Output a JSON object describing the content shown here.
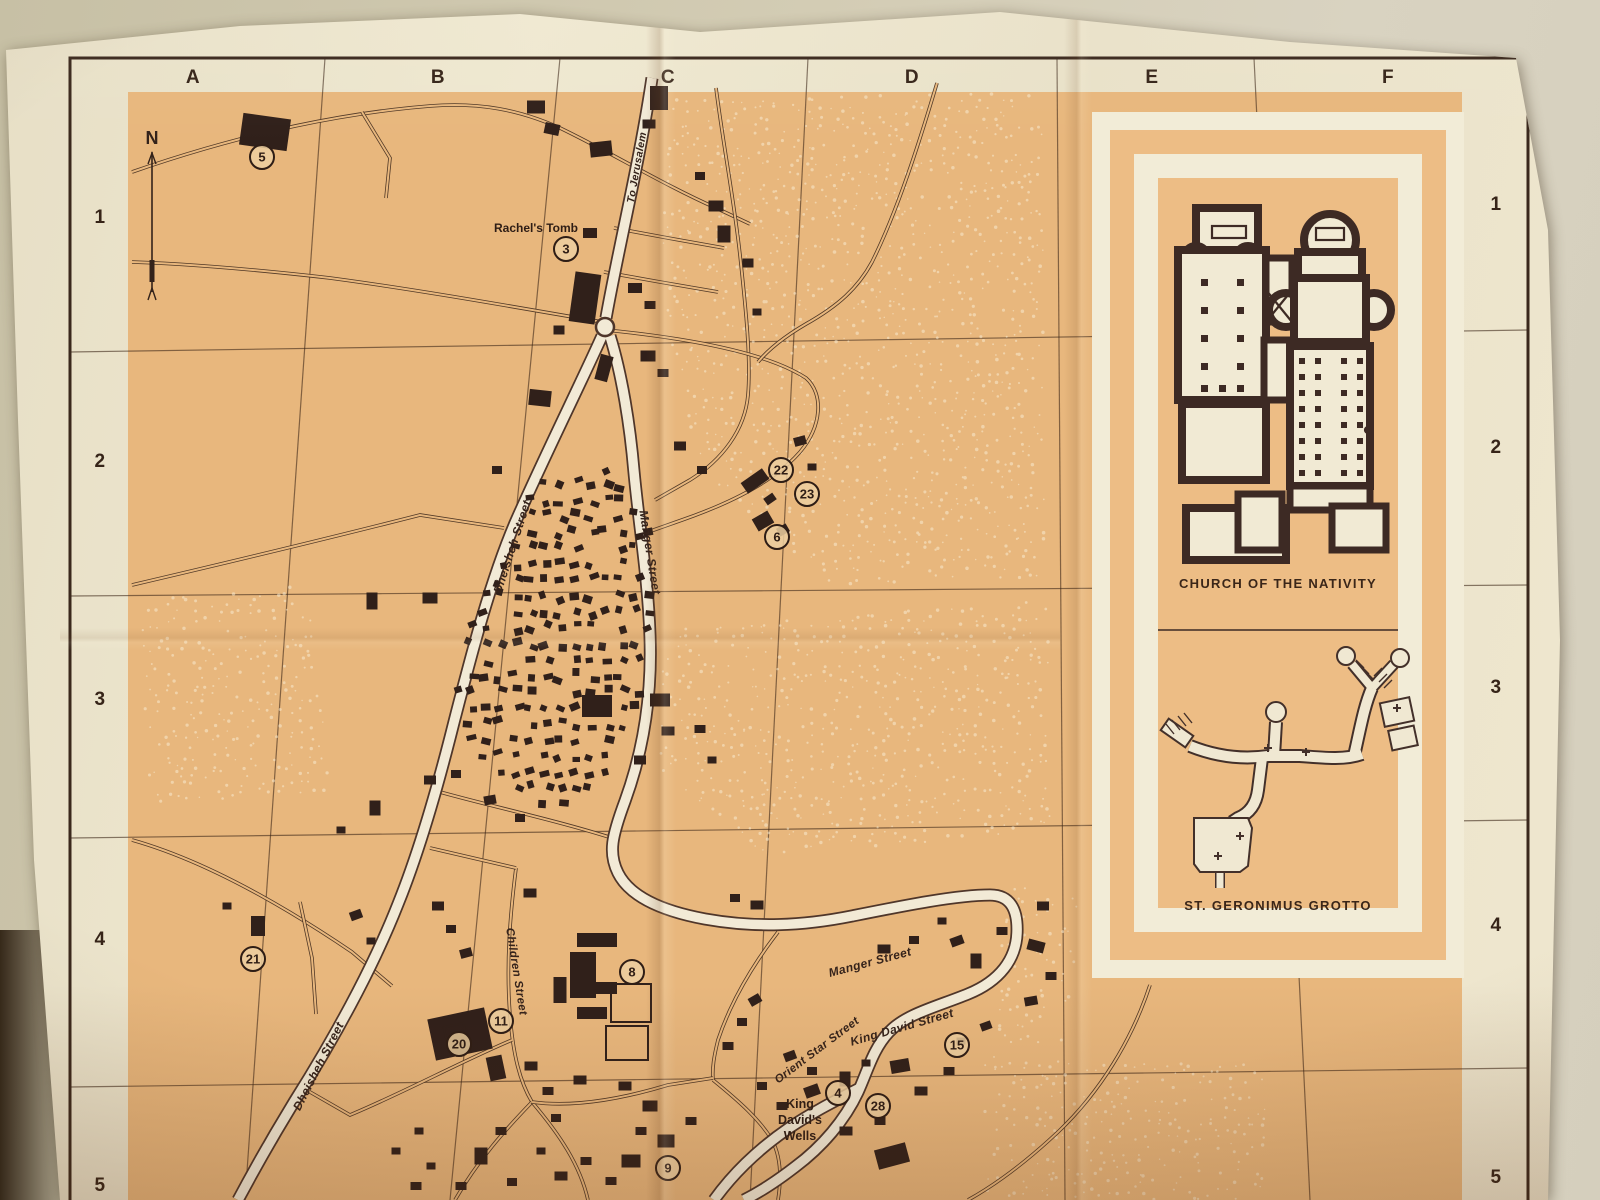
{
  "map_title_note": "Bethlehem street map sheet",
  "grid": {
    "columns": [
      "A",
      "B",
      "C",
      "D",
      "E",
      "F"
    ],
    "rows": [
      "1",
      "2",
      "3",
      "4",
      "5"
    ],
    "col_x": [
      193,
      438,
      668,
      912,
      1152,
      1388
    ],
    "row_left_y": [
      218,
      462,
      700,
      940,
      1186
    ],
    "row_right_y": [
      205,
      448,
      688,
      926,
      1178
    ]
  },
  "compass": {
    "label": "N",
    "x": 152,
    "y": 152
  },
  "inset": {
    "church_title": "CHURCH OF THE NATIVITY",
    "grotto_title": "ST. GERONIMUS GROTTO"
  },
  "colors": {
    "map_orange": "#e8b77d",
    "paper_cream": "#ece4cb",
    "line_dark": "#3a281c",
    "building": "#30201a",
    "road_fill": "#f2ead6",
    "road_casing": "#4f362a",
    "poi_fill": "#eccfa0",
    "inset_white": "#f2ecd7",
    "inset_orange": "#edbd85",
    "plan_wall": "#3d2a24",
    "speckle": "#f8ebd0"
  },
  "pois": [
    {
      "num": "5",
      "x": 262,
      "y": 157
    },
    {
      "num": "3",
      "x": 566,
      "y": 249
    },
    {
      "num": "22",
      "x": 781,
      "y": 470
    },
    {
      "num": "23",
      "x": 807,
      "y": 494
    },
    {
      "num": "6",
      "x": 777,
      "y": 537
    },
    {
      "num": "21",
      "x": 253,
      "y": 959
    },
    {
      "num": "8",
      "x": 632,
      "y": 972
    },
    {
      "num": "11",
      "x": 501,
      "y": 1021
    },
    {
      "num": "20",
      "x": 459,
      "y": 1044
    },
    {
      "num": "15",
      "x": 957,
      "y": 1045
    },
    {
      "num": "4",
      "x": 838,
      "y": 1093
    },
    {
      "num": "28",
      "x": 878,
      "y": 1106
    },
    {
      "num": "9",
      "x": 668,
      "y": 1168
    }
  ],
  "poi_labels": [
    {
      "text": "Rachel's Tomb",
      "x": 536,
      "y": 232,
      "rot": 0,
      "size": 12
    },
    {
      "text": "King",
      "x": 800,
      "y": 1108,
      "rot": 0,
      "size": 12.5
    },
    {
      "text": "David's",
      "x": 800,
      "y": 1124,
      "rot": 0,
      "size": 12.5
    },
    {
      "text": "Wells",
      "x": 800,
      "y": 1140,
      "rot": 0,
      "size": 12.5
    }
  ],
  "street_labels": [
    {
      "text": "To Jerusalem",
      "x": 640,
      "y": 168,
      "rot": -80,
      "size": 10.5
    },
    {
      "text": "Dheisheh Street",
      "x": 516,
      "y": 548,
      "rot": -72,
      "size": 12
    },
    {
      "text": "Manger Street",
      "x": 646,
      "y": 553,
      "rot": 81,
      "size": 12
    },
    {
      "text": "Children Street",
      "x": 513,
      "y": 972,
      "rot": 81,
      "size": 11.5
    },
    {
      "text": "Dheisheh Street",
      "x": 322,
      "y": 1068,
      "rot": -63,
      "size": 12
    },
    {
      "text": "Manger Street",
      "x": 871,
      "y": 966,
      "rot": -15,
      "size": 12
    },
    {
      "text": "Orient Star Street",
      "x": 819,
      "y": 1053,
      "rot": -37,
      "size": 11.5
    },
    {
      "text": "King David Street",
      "x": 903,
      "y": 1031,
      "rot": -16,
      "size": 12
    }
  ],
  "geometry": {
    "roundabout": {
      "x": 605,
      "y": 327,
      "r": 9
    },
    "roads_wide": [
      {
        "id": "jerusalem-road",
        "d": "M652,78 C640,160 618,250 606,318"
      },
      {
        "id": "dheisheh-street",
        "d": "M602,336 C580,385 545,455 515,523 C490,582 472,652 454,722 C437,790 417,857 398,904 C372,970 332,1042 294,1102 C272,1138 254,1170 238,1200"
      },
      {
        "id": "manger-street",
        "d": "M610,336 C622,375 630,425 634,472 C639,525 648,578 650,636 C652,691 645,746 625,801 C612,836 608,853 618,873 C630,897 662,911 705,919 C755,928 802,926 852,916 C902,906 956,895 990,895 C1010,895 1018,909 1017,933 C1016,959 1000,981 968,994 C936,1007 906,1014 889,1032 C873,1049 868,1070 858,1092 C845,1120 822,1147 795,1167 C773,1184 756,1194 744,1200"
      },
      {
        "id": "south-approach",
        "d": "M714,1200 C732,1175 757,1150 789,1128 C816,1110 841,1098 860,1088"
      }
    ],
    "roads_thin": [
      {
        "id": "north-lane",
        "d": "M132,172 C230,138 330,114 430,106 C480,102 520,110 560,128 C610,152 662,184 716,208 L750,224"
      },
      {
        "id": "north-lane-spur",
        "d": "M362,112 L390,158 L386,198"
      },
      {
        "id": "east-parallel-lane",
        "d": "M716,88 C724,150 734,200 740,255 C746,310 751,360 748,395 C745,430 722,460 690,480 L655,500"
      },
      {
        "id": "fork-east-loop",
        "d": "M606,330 C686,338 766,352 806,378 C824,394 822,426 800,452 C774,482 728,504 682,520 L648,532"
      },
      {
        "id": "d-column-road",
        "d": "M937,83 C920,140 898,210 872,262 C858,288 838,306 806,324 C782,338 768,350 758,362"
      },
      {
        "id": "cross-lane-1",
        "d": "M614,228 L668,238 L724,248"
      },
      {
        "id": "cross-lane-2",
        "d": "M604,272 L660,282 L718,292"
      },
      {
        "id": "west-lane",
        "d": "M602,322 C520,308 420,290 330,278 C260,270 190,264 132,262"
      },
      {
        "id": "west-lane-2",
        "d": "M132,585 C230,562 330,538 420,515 L504,528"
      },
      {
        "id": "southwest-lane",
        "d": "M132,840 C210,862 290,910 352,952 L392,986"
      },
      {
        "id": "southwest-spur",
        "d": "M300,902 L312,958 L316,1014"
      },
      {
        "id": "children-street",
        "d": "M516,868 C510,915 506,965 510,1015 C513,1055 520,1082 532,1102"
      },
      {
        "id": "children-link",
        "d": "M430,848 L516,868"
      },
      {
        "id": "camp-south-lane",
        "d": "M440,792 C490,806 555,820 612,838"
      },
      {
        "id": "orient-star-street",
        "d": "M778,932 C755,962 732,998 718,1040 C714,1056 712,1068 713,1080"
      },
      {
        "id": "inset-foot-road",
        "d": "M1150,985 C1132,1040 1100,1092 1058,1132 C1025,1163 995,1185 968,1200"
      },
      {
        "id": "town-sw-1",
        "d": "M532,1102 C505,1130 478,1160 455,1200"
      },
      {
        "id": "town-sw-2",
        "d": "M532,1102 C560,1135 580,1165 588,1200"
      },
      {
        "id": "town-east-link",
        "d": "M532,1102 C575,1108 625,1098 668,1085 L713,1078"
      },
      {
        "id": "town-west-link",
        "d": "M512,1040 C460,1062 405,1092 350,1115 L303,1088"
      },
      {
        "id": "wells-south-lane",
        "d": "M713,1080 C740,1102 760,1120 772,1140 C780,1155 782,1175 778,1200"
      }
    ],
    "grid_v": [
      [
        325,
        58,
        245,
        1200
      ],
      [
        560,
        58,
        450,
        1200
      ],
      [
        808,
        58,
        750,
        1200
      ],
      [
        1057,
        58,
        1065,
        1200
      ],
      [
        1254,
        58,
        1310,
        1200
      ]
    ],
    "grid_h": [
      [
        70,
        352,
        1528,
        330
      ],
      [
        70,
        596,
        1528,
        585
      ],
      [
        70,
        838,
        1528,
        820
      ],
      [
        70,
        1087,
        1528,
        1068
      ]
    ],
    "buildings": [
      [
        265,
        132,
        48,
        32,
        8
      ],
      [
        536,
        107,
        18,
        13,
        0
      ],
      [
        552,
        129,
        15,
        11,
        12
      ],
      [
        601,
        149,
        22,
        15,
        -6
      ],
      [
        659,
        98,
        18,
        24,
        0
      ],
      [
        649,
        124,
        13,
        9,
        0
      ],
      [
        700,
        176,
        10,
        8,
        0
      ],
      [
        716,
        206,
        15,
        11,
        0
      ],
      [
        724,
        234,
        13,
        17,
        0
      ],
      [
        748,
        263,
        11,
        9,
        0
      ],
      [
        585,
        298,
        26,
        50,
        8
      ],
      [
        559,
        330,
        11,
        9,
        0
      ],
      [
        635,
        288,
        14,
        10,
        0
      ],
      [
        650,
        305,
        11,
        8,
        0
      ],
      [
        590,
        233,
        14,
        10,
        0
      ],
      [
        757,
        312,
        9,
        7,
        0
      ],
      [
        648,
        356,
        15,
        11,
        0
      ],
      [
        663,
        373,
        11,
        8,
        0
      ],
      [
        604,
        368,
        13,
        26,
        15
      ],
      [
        540,
        398,
        22,
        16,
        6
      ],
      [
        497,
        470,
        10,
        8,
        0
      ],
      [
        755,
        481,
        26,
        13,
        -35
      ],
      [
        770,
        499,
        11,
        8,
        -35
      ],
      [
        763,
        521,
        18,
        14,
        -30
      ],
      [
        783,
        530,
        11,
        9,
        -30
      ],
      [
        680,
        446,
        12,
        9,
        0
      ],
      [
        702,
        470,
        10,
        8,
        0
      ],
      [
        800,
        441,
        12,
        9,
        -15
      ],
      [
        812,
        467,
        9,
        7,
        0
      ],
      [
        430,
        598,
        15,
        11,
        0
      ],
      [
        372,
        601,
        11,
        17,
        0
      ],
      [
        597,
        706,
        30,
        22,
        0
      ],
      [
        640,
        760,
        12,
        9,
        0
      ],
      [
        660,
        700,
        20,
        13,
        0
      ],
      [
        668,
        731,
        13,
        9,
        0
      ],
      [
        700,
        729,
        11,
        8,
        0
      ],
      [
        712,
        760,
        9,
        7,
        0
      ],
      [
        430,
        780,
        12,
        9,
        0
      ],
      [
        456,
        774,
        10,
        8,
        0
      ],
      [
        490,
        800,
        12,
        9,
        -10
      ],
      [
        520,
        818,
        10,
        8,
        0
      ],
      [
        375,
        808,
        11,
        15,
        0
      ],
      [
        341,
        830,
        9,
        7,
        0
      ],
      [
        258,
        926,
        14,
        20,
        0
      ],
      [
        227,
        906,
        9,
        7,
        0
      ],
      [
        356,
        915,
        12,
        9,
        -20
      ],
      [
        371,
        941,
        9,
        7,
        0
      ],
      [
        438,
        906,
        12,
        9,
        0
      ],
      [
        451,
        929,
        10,
        8,
        0
      ],
      [
        466,
        953,
        12,
        9,
        -15
      ],
      [
        530,
        893,
        13,
        9,
        0
      ],
      [
        597,
        940,
        40,
        14,
        0
      ],
      [
        583,
        975,
        26,
        46,
        0
      ],
      [
        606,
        988,
        22,
        12,
        0
      ],
      [
        592,
        1013,
        30,
        12,
        0
      ],
      [
        560,
        990,
        13,
        26,
        0
      ],
      [
        460,
        1034,
        58,
        42,
        -12
      ],
      [
        496,
        1068,
        16,
        24,
        -12
      ],
      [
        531,
        1066,
        13,
        9,
        0
      ],
      [
        548,
        1091,
        11,
        8,
        0
      ],
      [
        580,
        1080,
        13,
        9,
        0
      ],
      [
        625,
        1086,
        13,
        9,
        0
      ],
      [
        650,
        1106,
        15,
        11,
        0
      ],
      [
        641,
        1131,
        11,
        8,
        0
      ],
      [
        666,
        1141,
        17,
        13,
        0
      ],
      [
        691,
        1121,
        11,
        8,
        0
      ],
      [
        631,
        1161,
        19,
        13,
        0
      ],
      [
        611,
        1181,
        11,
        8,
        0
      ],
      [
        586,
        1161,
        11,
        8,
        0
      ],
      [
        561,
        1176,
        13,
        9,
        0
      ],
      [
        541,
        1151,
        9,
        7,
        0
      ],
      [
        501,
        1131,
        11,
        8,
        0
      ],
      [
        481,
        1156,
        13,
        17,
        0
      ],
      [
        461,
        1186,
        11,
        8,
        0
      ],
      [
        431,
        1166,
        9,
        7,
        0
      ],
      [
        416,
        1186,
        11,
        8,
        0
      ],
      [
        396,
        1151,
        9,
        7,
        0
      ],
      [
        419,
        1131,
        9,
        7,
        0
      ],
      [
        512,
        1182,
        10,
        8,
        0
      ],
      [
        556,
        1118,
        10,
        8,
        0
      ],
      [
        790,
        1056,
        12,
        9,
        -20
      ],
      [
        812,
        1071,
        10,
        8,
        0
      ],
      [
        845,
        1079,
        11,
        15,
        0
      ],
      [
        866,
        1063,
        9,
        7,
        0
      ],
      [
        900,
        1066,
        19,
        13,
        -10
      ],
      [
        921,
        1091,
        13,
        9,
        0
      ],
      [
        949,
        1071,
        11,
        8,
        0
      ],
      [
        880,
        1121,
        11,
        8,
        0
      ],
      [
        846,
        1131,
        13,
        9,
        0
      ],
      [
        812,
        1091,
        15,
        11,
        -20
      ],
      [
        892,
        1156,
        32,
        20,
        -15
      ],
      [
        782,
        1106,
        11,
        8,
        0
      ],
      [
        762,
        1086,
        10,
        8,
        0
      ],
      [
        884,
        949,
        13,
        9,
        0
      ],
      [
        914,
        940,
        10,
        8,
        0
      ],
      [
        942,
        921,
        9,
        7,
        0
      ],
      [
        957,
        941,
        13,
        9,
        -20
      ],
      [
        976,
        961,
        11,
        15,
        0
      ],
      [
        1002,
        931,
        11,
        8,
        0
      ],
      [
        1036,
        946,
        17,
        11,
        15
      ],
      [
        1051,
        976,
        11,
        8,
        0
      ],
      [
        1031,
        1001,
        13,
        9,
        -10
      ],
      [
        986,
        1026,
        11,
        8,
        -20
      ],
      [
        961,
        1041,
        9,
        7,
        0
      ],
      [
        757,
        905,
        13,
        9,
        0
      ],
      [
        735,
        898,
        10,
        8,
        0
      ],
      [
        1043,
        906,
        12,
        9,
        0
      ],
      [
        755,
        1000,
        12,
        9,
        -30
      ],
      [
        742,
        1022,
        10,
        8,
        0
      ],
      [
        728,
        1046,
        11,
        8,
        0
      ]
    ],
    "buildings_hollow": [
      [
        631,
        1003,
        40,
        38,
        0
      ],
      [
        627,
        1043,
        42,
        34,
        0
      ],
      [
        455,
        1032,
        20,
        14,
        -12
      ]
    ],
    "camp_polygon": [
      [
        535,
        478
      ],
      [
        612,
        468
      ],
      [
        648,
        522
      ],
      [
        655,
        602
      ],
      [
        642,
        690
      ],
      [
        616,
        754
      ],
      [
        590,
        800
      ],
      [
        546,
        806
      ],
      [
        504,
        788
      ],
      [
        472,
        750
      ],
      [
        456,
        704
      ],
      [
        463,
        646
      ],
      [
        483,
        588
      ],
      [
        509,
        530
      ]
    ],
    "speckle_regions": [
      [
        [
          665,
          100
        ],
        [
          1045,
          92
        ],
        [
          1048,
          580
        ],
        [
          830,
          590
        ],
        [
          700,
          470
        ],
        [
          662,
          300
        ]
      ],
      [
        [
          662,
          630
        ],
        [
          1048,
          600
        ],
        [
          1050,
          830
        ],
        [
          770,
          858
        ],
        [
          660,
          770
        ]
      ],
      [
        [
          985,
          1055
        ],
        [
          1265,
          1062
        ],
        [
          1265,
          1200
        ],
        [
          985,
          1200
        ]
      ],
      [
        [
          1010,
          880
        ],
        [
          1085,
          900
        ],
        [
          1060,
          1050
        ],
        [
          990,
          1040
        ]
      ],
      [
        [
          140,
          600
        ],
        [
          310,
          585
        ],
        [
          330,
          790
        ],
        [
          150,
          810
        ]
      ]
    ]
  }
}
